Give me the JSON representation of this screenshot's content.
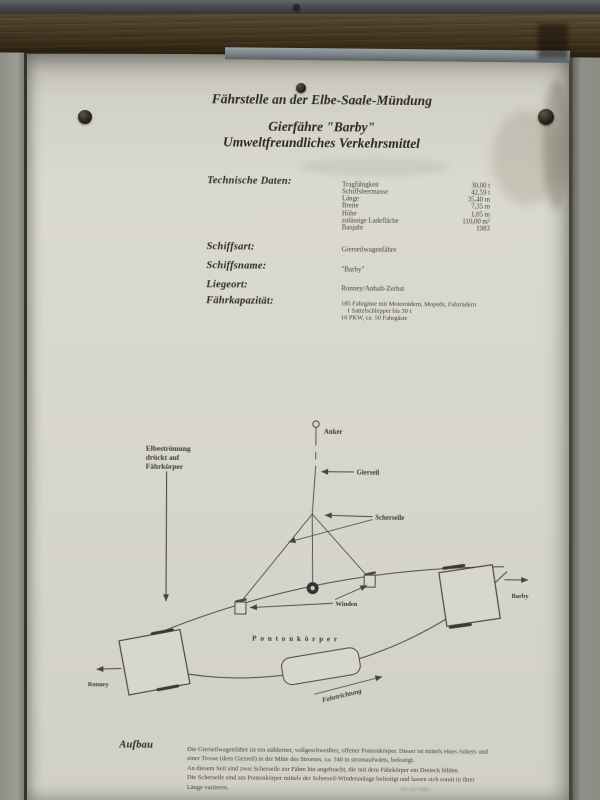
{
  "colors": {
    "board": "#d9d8d0",
    "wood": "#4a3c26",
    "wall": "#92928a",
    "ink": "#3a372e"
  },
  "poster": {
    "title": {
      "line1": "Fährstelle an der Elbe-Saale-Mündung",
      "line2": "Gierfähre \"Barby\"",
      "line3": "Umweltfreundliches Verkehrsmittel"
    },
    "tech": {
      "label": "Technische Daten:",
      "rows": [
        {
          "name": "Tragfähigkeit",
          "value": "30,00 t"
        },
        {
          "name": "Schiffsleermasse",
          "value": "42,59 t"
        },
        {
          "name": "Länge",
          "value": "35,40 m"
        },
        {
          "name": "Breite",
          "value": "7,35 m"
        },
        {
          "name": "Höhe",
          "value": "1,05 m"
        },
        {
          "name": "zulässige Ladefläche",
          "value": "110,00 m²"
        },
        {
          "name": "Baujahr",
          "value": "1983"
        }
      ]
    },
    "fields": {
      "schiffsart": {
        "label": "Schiffsart:",
        "value": "Gierseilwagenfähre"
      },
      "schiffsname": {
        "label": "Schiffsname:",
        "value": "\"Barby\""
      },
      "liegeort": {
        "label": "Liegeort:",
        "value": "Ronney/Anhalt-Zerbst"
      },
      "faehrkapazitaet": {
        "label": "Fährkapazität:",
        "lines": [
          "185 Fahrgäste mit Motorrädern, Mopeds, Fahrrädern",
          "1 Sattelschlepper bis 30 t",
          "10 PKW, ca. 50 Fahrgäste"
        ]
      }
    },
    "diagram": {
      "anker": "Anker",
      "gierseil": "Gierseil",
      "scherseile": "Scherseile",
      "stroemung": [
        "Elbeströmung",
        "drückt auf",
        "Fährkörper"
      ],
      "winden": "Winden",
      "pontonkoerper": "Pontonkörper",
      "fahrtrichtung": "Fahrtrichtung",
      "ronney": "Ronney",
      "barby": "Barby"
    },
    "aufbau": {
      "label": "Aufbau",
      "lines": [
        "Die Gierseilwagenfähre ist ein stählerner, vollgeschweißter, offener Pontonkörper. Dieser ist mittels eines Ankers und",
        "einer Trosse (dem Gierseil) in der Mitte des Stromes, ca. 340 m stromaufwärts, befestigt.",
        "An diesem Seil sind zwei Scherseile zur Fähre hin angebracht, die mit dem Fährkörper ein Dreieck bilden.",
        "Die Scherseile sind am Pontonkörper mittels der Scherseil-Windenanlage befestigt und lassen sich somit in ihrer",
        "Länge variieren."
      ]
    },
    "bottom_fragment": "… bei der Fähr…"
  }
}
